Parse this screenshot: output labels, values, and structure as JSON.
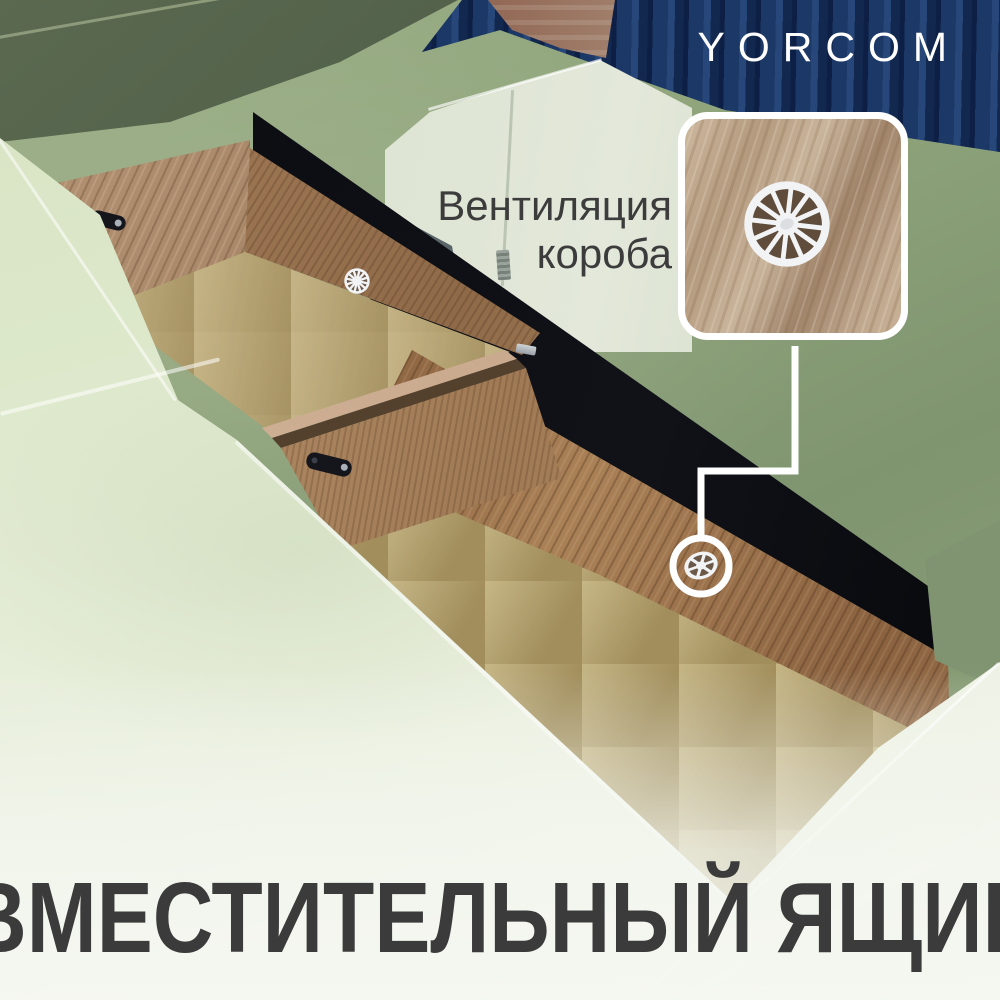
{
  "brand": {
    "logo": "YORCOM"
  },
  "callout": {
    "line1": "Вентиляция",
    "line2": "короба"
  },
  "headline": "ВМЕСТИТЕЛЬНЫЙ ЯЩИК",
  "icons": {
    "vent_grommet": "spoked-wheel-vent",
    "callout_connector": "elbow-line-with-circle-marker"
  },
  "colors": {
    "sofa_green": "#8ea37a",
    "seat_pale_green": "#dde8cb",
    "wood_oak": "#a9855f",
    "fiberboard_tan": "#b3a06e",
    "black_fabric": "#0a0b0f",
    "wall_blue": "#1c3866",
    "brick_red": "#8a5a48",
    "text_dark": "#3b3b3b",
    "text_light": "#ffffff"
  }
}
